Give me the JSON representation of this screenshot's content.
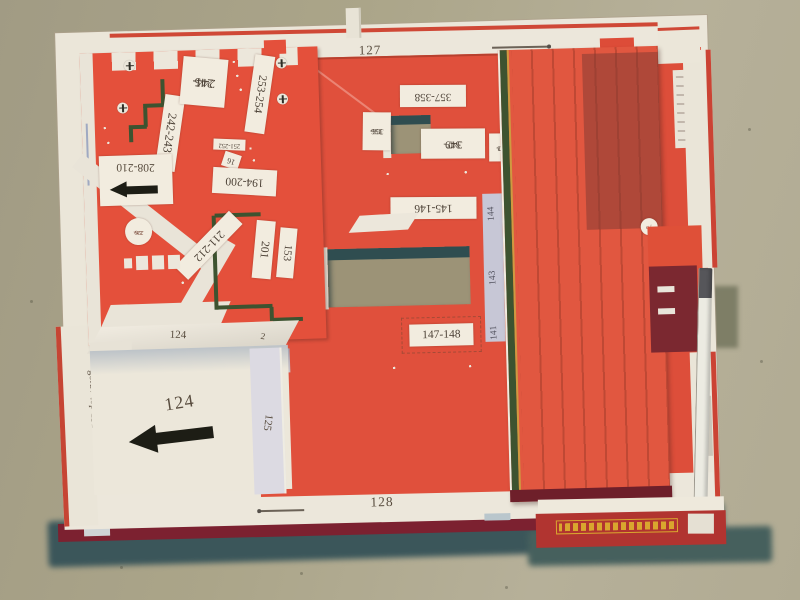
{
  "labels": {
    "top_edge": "127",
    "bottom_edge": "128",
    "left_border": "góra / top 131",
    "left_border_small": "124",
    "floor_number": "124",
    "box_edge_number": "124",
    "box_edge_corner": "2",
    "divider": "125",
    "step": "126",
    "b242": "242-243",
    "b244a": "244-",
    "b244b": "245",
    "b253": "253-254",
    "b251": "251-252",
    "b208": "208-210",
    "b194": "194-200",
    "b16": "16",
    "b211": "211-212",
    "b201": "201",
    "b153": "153",
    "c226a": "226-",
    "c226b": "229",
    "m357": "357-358",
    "m355a": "355-",
    "m355b": "356",
    "m347a": "347-",
    "m347b": "349",
    "m350a": "350-",
    "m350b": "353",
    "m145": "145-146",
    "m147": "147-148",
    "s142": "142",
    "s144": "144",
    "s143": "143",
    "s141": "141",
    "c75": "75"
  },
  "colors": {
    "red_paper": "#e0503a",
    "dark_red_edge": "#7c2130",
    "green_line": "#3d5330",
    "cardboard": "#aaa48c",
    "paper_white": "#ece7db",
    "shadow_teal": "#3b565a",
    "yellow_accent": "#d9a62e"
  }
}
